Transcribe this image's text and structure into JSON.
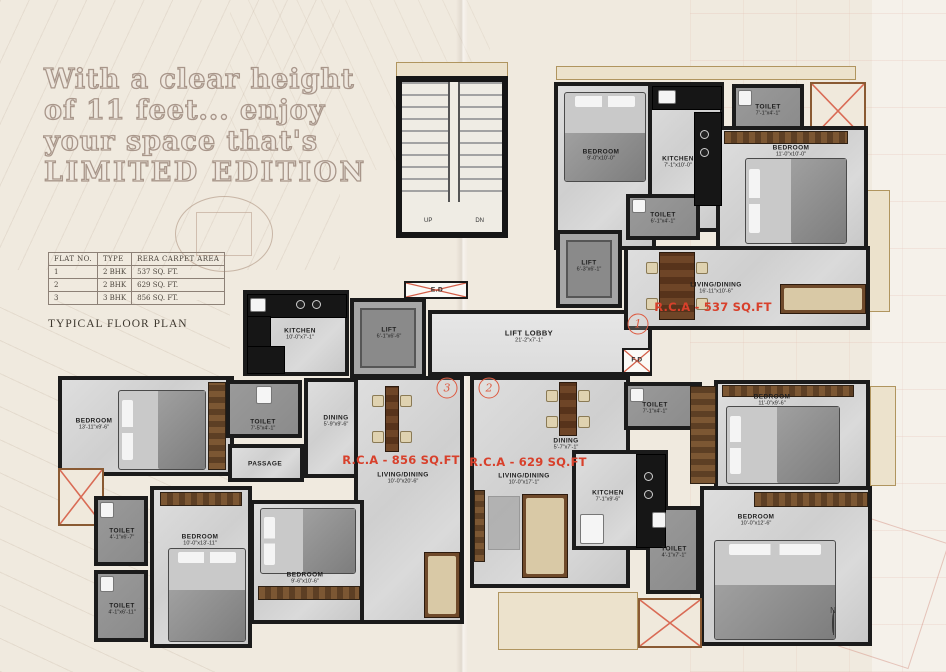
{
  "header": {
    "lines": [
      "With a clear height",
      "of 11 feet... enjoy",
      "your space that's",
      "LIMITED EDITION"
    ]
  },
  "table": {
    "headers": [
      "FLAT NO.",
      "TYPE",
      "RERA CARPET AREA"
    ],
    "rows": [
      [
        "1",
        "2 BHK",
        "537 SQ. FT."
      ],
      [
        "2",
        "2 BHK",
        "629 SQ. FT."
      ],
      [
        "3",
        "3 BHK",
        "856 SQ. FT."
      ]
    ]
  },
  "plan_title": "TYPICAL FLOOR PLAN",
  "plan": {
    "rooms": {
      "bedroom1": {
        "name": "BEDROOM",
        "dims": "9'-0\"x10'-0\""
      },
      "kitchen1": {
        "name": "KITCHEN",
        "dims": "7'-1\"x10'-0\""
      },
      "toilet1": {
        "name": "TOILET",
        "dims": "7'-1\"x4'-1\""
      },
      "bedroom2": {
        "name": "BEDROOM",
        "dims": "11'-0\"x10'-0\""
      },
      "toilet2": {
        "name": "TOILET",
        "dims": "6'-1\"x4'-1\""
      },
      "lift1": {
        "name": "LIFT",
        "dims": "6'-3\"x6'-1\""
      },
      "living1": {
        "name": "LIVING/DINING",
        "dims": "16'-11\"x10'-6\""
      },
      "lobby": {
        "name": "LIFT LOBBY",
        "dims": "21'-2\"x7'-1\""
      },
      "lift2": {
        "name": "LIFT",
        "dims": "6'-1\"x6'-6\""
      },
      "kitchen3": {
        "name": "KITCHEN",
        "dims": "10'-0\"x7'-1\""
      },
      "bedroom3": {
        "name": "BEDROOM",
        "dims": "13'-11\"x9'-6\""
      },
      "toilet3": {
        "name": "TOILET",
        "dims": "7'-5\"x4'-1\""
      },
      "dining3": {
        "name": "DINING",
        "dims": "5'-9\"x9'-6\""
      },
      "passage": {
        "name": "PASSAGE",
        "dims": ""
      },
      "living3": {
        "name": "LIVING/DINING",
        "dims": "10'-0\"x20'-6\""
      },
      "toilet4": {
        "name": "TOILET",
        "dims": "4'-1\"x6'-7\""
      },
      "toilet5": {
        "name": "TOILET",
        "dims": "4'-1\"x6'-11\""
      },
      "bedroom4": {
        "name": "BEDROOM",
        "dims": "10'-0\"x13'-11\""
      },
      "bedroom5": {
        "name": "BEDROOM",
        "dims": "9'-6\"x10'-6\""
      },
      "dining2": {
        "name": "DINING",
        "dims": "5'-7\"x7'-1\""
      },
      "living2": {
        "name": "LIVING/DINING",
        "dims": "10'-0\"x17'-1\""
      },
      "toilet6": {
        "name": "TOILET",
        "dims": "7'-1\"x4'-1\""
      },
      "bedroom6": {
        "name": "BEDROOM",
        "dims": "11'-0\"x9'-6\""
      },
      "kitchen2": {
        "name": "KITCHEN",
        "dims": "7'-1\"x9'-6\""
      },
      "toilet7": {
        "name": "TOILET",
        "dims": "4'-1\"x7'-1\""
      },
      "bedroom7": {
        "name": "BEDROOM",
        "dims": "10'-0\"x12'-6\""
      }
    },
    "rca": {
      "flat1": "R.C.A - 537 SQ.FT",
      "flat2": "R.C.A - 629 SQ.FT",
      "flat3": "R.C.A - 856 SQ.FT"
    },
    "markers": {
      "m1": "1",
      "m2": "2",
      "m3": "3"
    },
    "stairs": {
      "up": "UP",
      "dn": "DN"
    },
    "ducts": {
      "ed": "E.D",
      "fd": "F.D"
    },
    "compass": "N"
  },
  "colors": {
    "accent_red": "#d8402b",
    "wall": "#1b1b1b",
    "paper": "#f0eadf",
    "heading": "#a8968a"
  }
}
